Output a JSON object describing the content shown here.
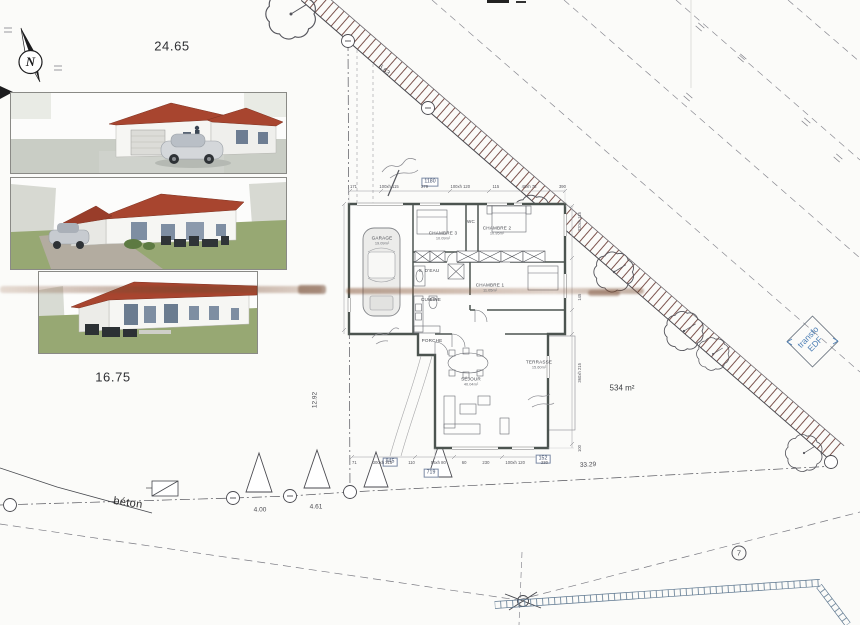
{
  "compass": {
    "n": "N"
  },
  "site": {
    "plot_top": "24.65",
    "plot_left": "16.75",
    "area": "534 m²",
    "road_len": "6.63",
    "dist1": "4.00",
    "dist2": "4.61",
    "dist3": "33.29",
    "left_height": "12.92",
    "beton": "béton",
    "transfo_line1": "transfo",
    "transfo_line2": "EDF",
    "point7": "7"
  },
  "plan": {
    "boxed_width": "1180",
    "boxed_a": "945",
    "boxed_b": "719",
    "boxed_c": "152",
    "dims_top": [
      "171",
      "100xh 115",
      "279",
      "100xh 120",
      "115",
      "40xh 75",
      "390"
    ],
    "dims_bottom": [
      "71",
      "300xh 215",
      "110",
      "55xh 80",
      "60",
      "230",
      "100xh 120",
      "230"
    ],
    "dims_right": [
      "100",
      "360xh 215",
      "145",
      "320xh 115"
    ],
    "rooms": {
      "garage": {
        "name": "GARAGE",
        "area": "19.09m²"
      },
      "chambre3": {
        "name": "CHAMBRE 3",
        "area": "10.09m²"
      },
      "chambre2": {
        "name": "CHAMBRE 2",
        "area": "10.95m²"
      },
      "chambre1": {
        "name": "CHAMBRE 1",
        "area": "11.05m²"
      },
      "wc": {
        "name": "WC"
      },
      "sde": {
        "name": "S. D'EAU"
      },
      "cuisine": {
        "name": "CUISINE"
      },
      "porche": {
        "name": "PORCHE"
      },
      "sejour": {
        "name": "SÉJOUR",
        "area": "40.04m²"
      },
      "terrasse": {
        "name": "TERRASSE",
        "area": "15.60m²"
      }
    }
  },
  "colors": {
    "roof": "#a8452f",
    "grass": "#97a873",
    "road_hatch": "#7c534d",
    "fence": "#71889d",
    "blue_text": "#4d7fb5"
  }
}
